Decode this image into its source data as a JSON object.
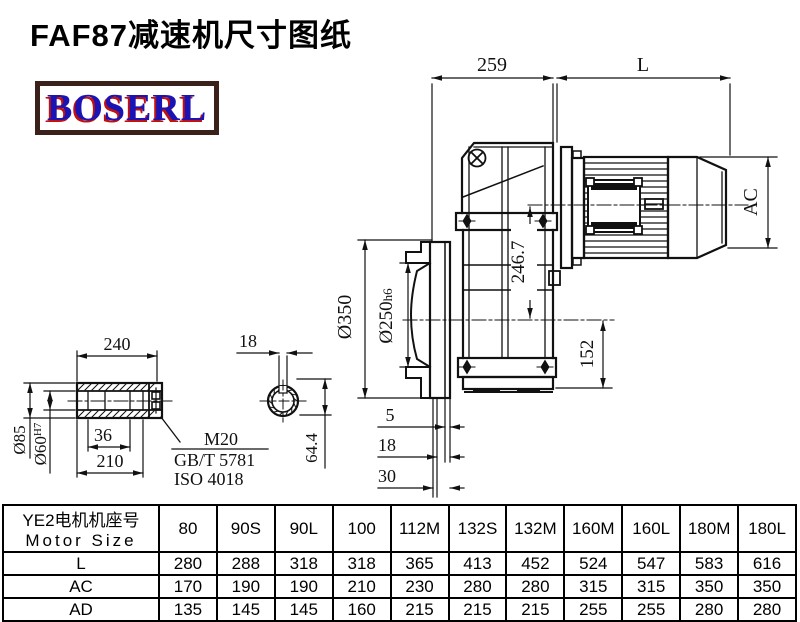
{
  "title": "FAF87减速机尺寸图纸",
  "logo": {
    "text": "BOSERL"
  },
  "drawing": {
    "dims": {
      "width_259": "259",
      "motor_len": "L",
      "motor_dia": "AC",
      "center_height": "246.7",
      "base_height": "152",
      "flange_dia": "Ø350",
      "spigot_dia": "Ø250",
      "spigot_tol": "h6",
      "flange_t5": "5",
      "flange_t18": "18",
      "flange_t30": "30"
    },
    "shaft": {
      "length": "240",
      "outer_dia": "Ø85",
      "bore_dia": "Ø60",
      "bore_tol": "H7",
      "len36": "36",
      "len210": "210",
      "thread": "M20",
      "std_gb": "GB/T 5781",
      "std_iso": "ISO 4018",
      "key_width": "18",
      "key_depth": "64.4"
    }
  },
  "table": {
    "header_cn": "YE2电机机座号",
    "header_en": "Motor Size",
    "columns": [
      "80",
      "90S",
      "90L",
      "100",
      "112M",
      "132S",
      "132M",
      "160M",
      "160L",
      "180M",
      "180L"
    ],
    "rows": [
      {
        "label": "L",
        "values": [
          "280",
          "288",
          "318",
          "318",
          "365",
          "413",
          "452",
          "524",
          "547",
          "583",
          "616"
        ]
      },
      {
        "label": "AC",
        "values": [
          "170",
          "190",
          "190",
          "210",
          "230",
          "280",
          "280",
          "315",
          "315",
          "350",
          "350"
        ]
      },
      {
        "label": "AD",
        "values": [
          "135",
          "145",
          "145",
          "160",
          "215",
          "215",
          "215",
          "255",
          "255",
          "280",
          "280"
        ]
      }
    ]
  }
}
